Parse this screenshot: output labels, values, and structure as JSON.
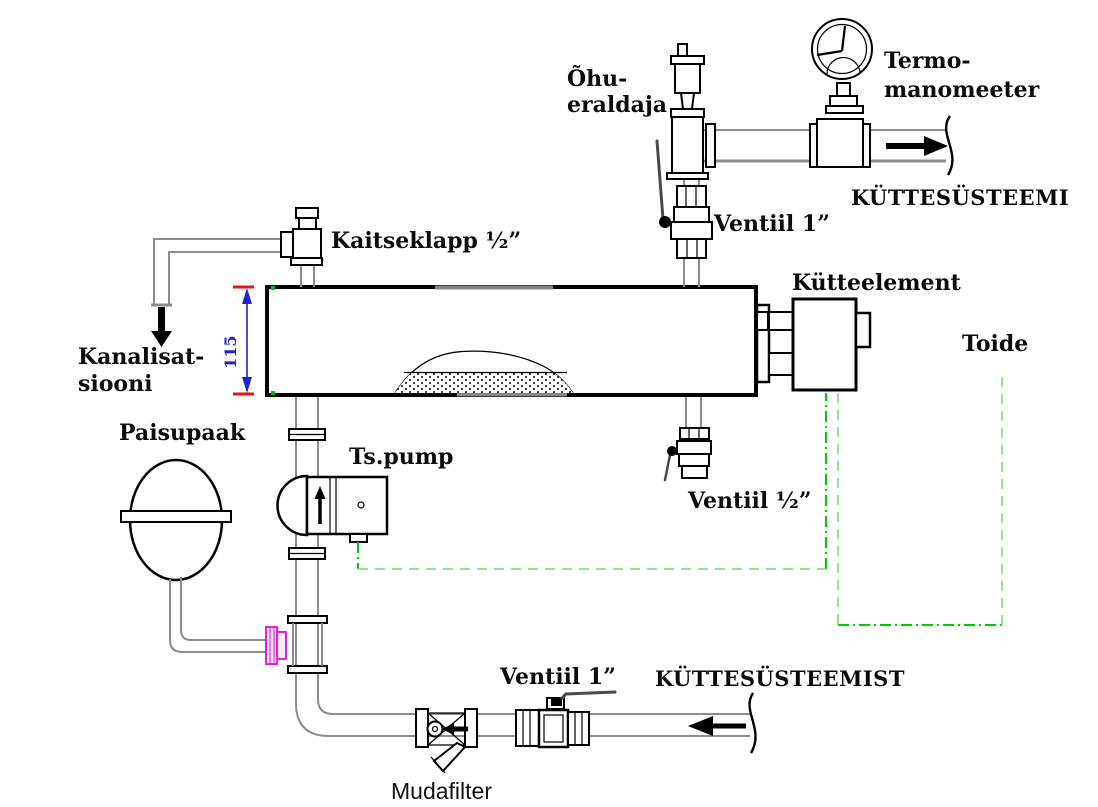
{
  "labels": {
    "air_separator": {
      "line1": "Õhu-",
      "line2": "eraldaja"
    },
    "thermo_manometer": {
      "line1": "Termo-",
      "line2": "manomeeter"
    },
    "to_heating_system": "KÜTTESÜSTEEMI",
    "valve_1in_top": "Ventiil 1”",
    "safety_valve": "Kaitseklapp ½”",
    "to_sewer": {
      "line1": "Kanalisat-",
      "line2": "siooni"
    },
    "tank_height_dim": "115",
    "heating_element": "Kütteelement",
    "power_supply": "Toide",
    "expansion_tank": "Paisupaak",
    "circulation_pump": "Ts.pump",
    "valve_half_in": "Ventiil ½”",
    "valve_1in_bottom": "Ventiil 1”",
    "from_heating_system": "KÜTTESÜSTEEMIST",
    "mud_filter": "Mudafilter"
  },
  "colors": {
    "line_black": "#000000",
    "pipe_gray": "#8c8c8c",
    "wire_green_bright": "#00cc00",
    "wire_green_light": "#8ee68e",
    "dimension_red": "#e81313",
    "dimension_blue": "#2222cc",
    "flange_magenta": "#dd22dd"
  }
}
